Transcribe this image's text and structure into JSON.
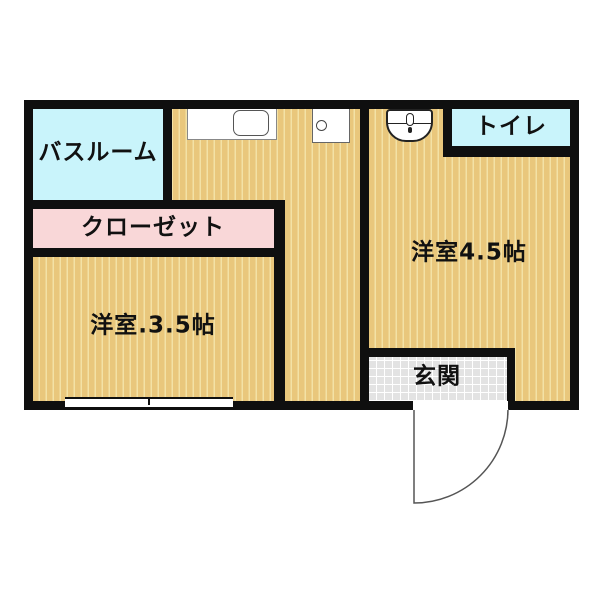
{
  "rooms": {
    "bathroom": {
      "label": "バスルーム"
    },
    "closet": {
      "label": "クローゼット"
    },
    "western_room_3_5": {
      "label": "洋室.3.5帖"
    },
    "western_room_4_5": {
      "label": "洋室4.5帖"
    },
    "toilet": {
      "label": "トイレ"
    },
    "entrance": {
      "label": "玄関"
    }
  },
  "fixtures": {
    "kitchen_sink": "kitchen-sink",
    "stove": "stove-unit",
    "toilet_bowl": "toilet-bowl",
    "window": "window-symbol",
    "entrance_door": "entrance-door-swing"
  },
  "colors": {
    "wall": "#0f0f0f",
    "floor_stripe_base": "#e9c77c",
    "floor_stripe_line": "#f3e2a6",
    "wet_room": "#c9f4fb",
    "closet": "#f9d7d8",
    "entrance_tile": "#e3e3e3"
  }
}
